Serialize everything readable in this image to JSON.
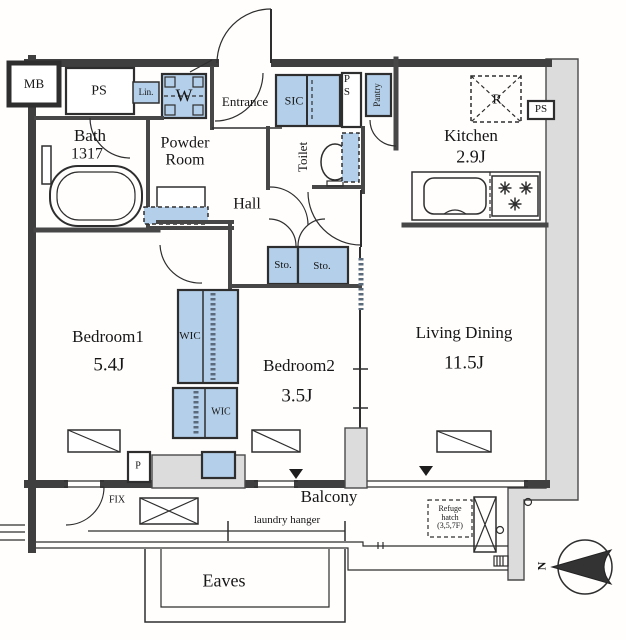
{
  "colors": {
    "closet_fill": "#b4cfe9",
    "wall_gray": "#dcdcdc",
    "line": "#3f3f3f"
  },
  "labels": {
    "mb": "MB",
    "ps_top_left": "PS",
    "linen": "Lin.",
    "washer": "W",
    "entrance": "Entrance",
    "sic": "SIC",
    "ps_mid": "PS",
    "pantry": "Pantry",
    "bath": {
      "name": "Bath",
      "size": "1317"
    },
    "powder_room": {
      "line1": "Powder",
      "line2": "Room"
    },
    "toilet": "Toilet",
    "hall": "Hall",
    "kitchen": {
      "name": "Kitchen",
      "size": "2.9J"
    },
    "refrigerator": "R",
    "ps_right": "PS",
    "storage1": "Sto.",
    "storage2": "Sto.",
    "wic_upper": "WIC",
    "wic_lower": "WIC",
    "bedroom1": {
      "name": "Bedroom1",
      "size": "5.4J"
    },
    "bedroom2": {
      "name": "Bedroom2",
      "size": "3.5J"
    },
    "living_dining": {
      "name": "Living Dining",
      "size": "11.5J"
    },
    "balcony": "Balcony",
    "fix_window": "FIX",
    "pipe_p": "P",
    "laundry_hanger": "laundry hanger",
    "refuge_hatch": {
      "line1": "Refuge",
      "line2": "hatch",
      "line3": "(3,5,7F)"
    },
    "eaves": "Eaves",
    "compass_north": "N"
  }
}
